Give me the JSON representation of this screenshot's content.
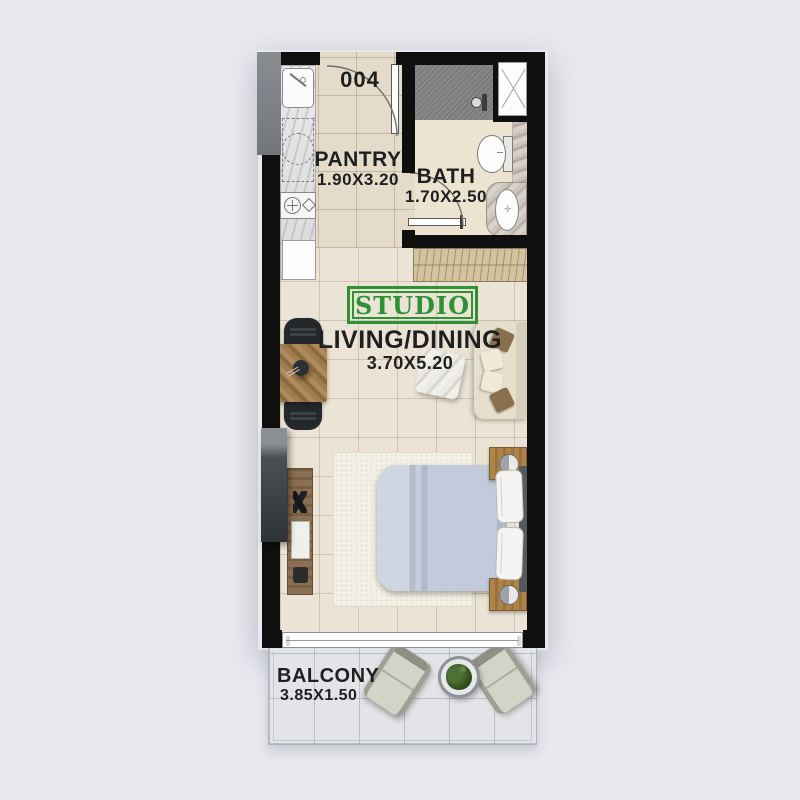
{
  "title": "Studio apartment floor plan",
  "unit": {
    "number": "004",
    "type_label": "STUDIO"
  },
  "rooms": {
    "pantry": {
      "name": "PANTRY",
      "dims": "1.90X3.20"
    },
    "bath": {
      "name": "BATH",
      "dims": "1.70X2.50"
    },
    "living": {
      "name": "LIVING/DINING",
      "dims": "3.70X5.20"
    },
    "balcony": {
      "name": "BALCONY",
      "dims": "3.85X1.50"
    }
  },
  "colors": {
    "background": "#e8e9ee",
    "wall": "#0f0f0f",
    "accent_green": "#2e9134",
    "label_text": "#1f1f1f"
  },
  "icons": {
    "shower_head": "circle-with-arm",
    "duct_shaft": "box-with-x",
    "washer": "dashed-circle",
    "stove_burners": "circle-plus-and-diamond",
    "lamp": "half-shaded-circle",
    "plant": "green-blob-in-ring"
  }
}
